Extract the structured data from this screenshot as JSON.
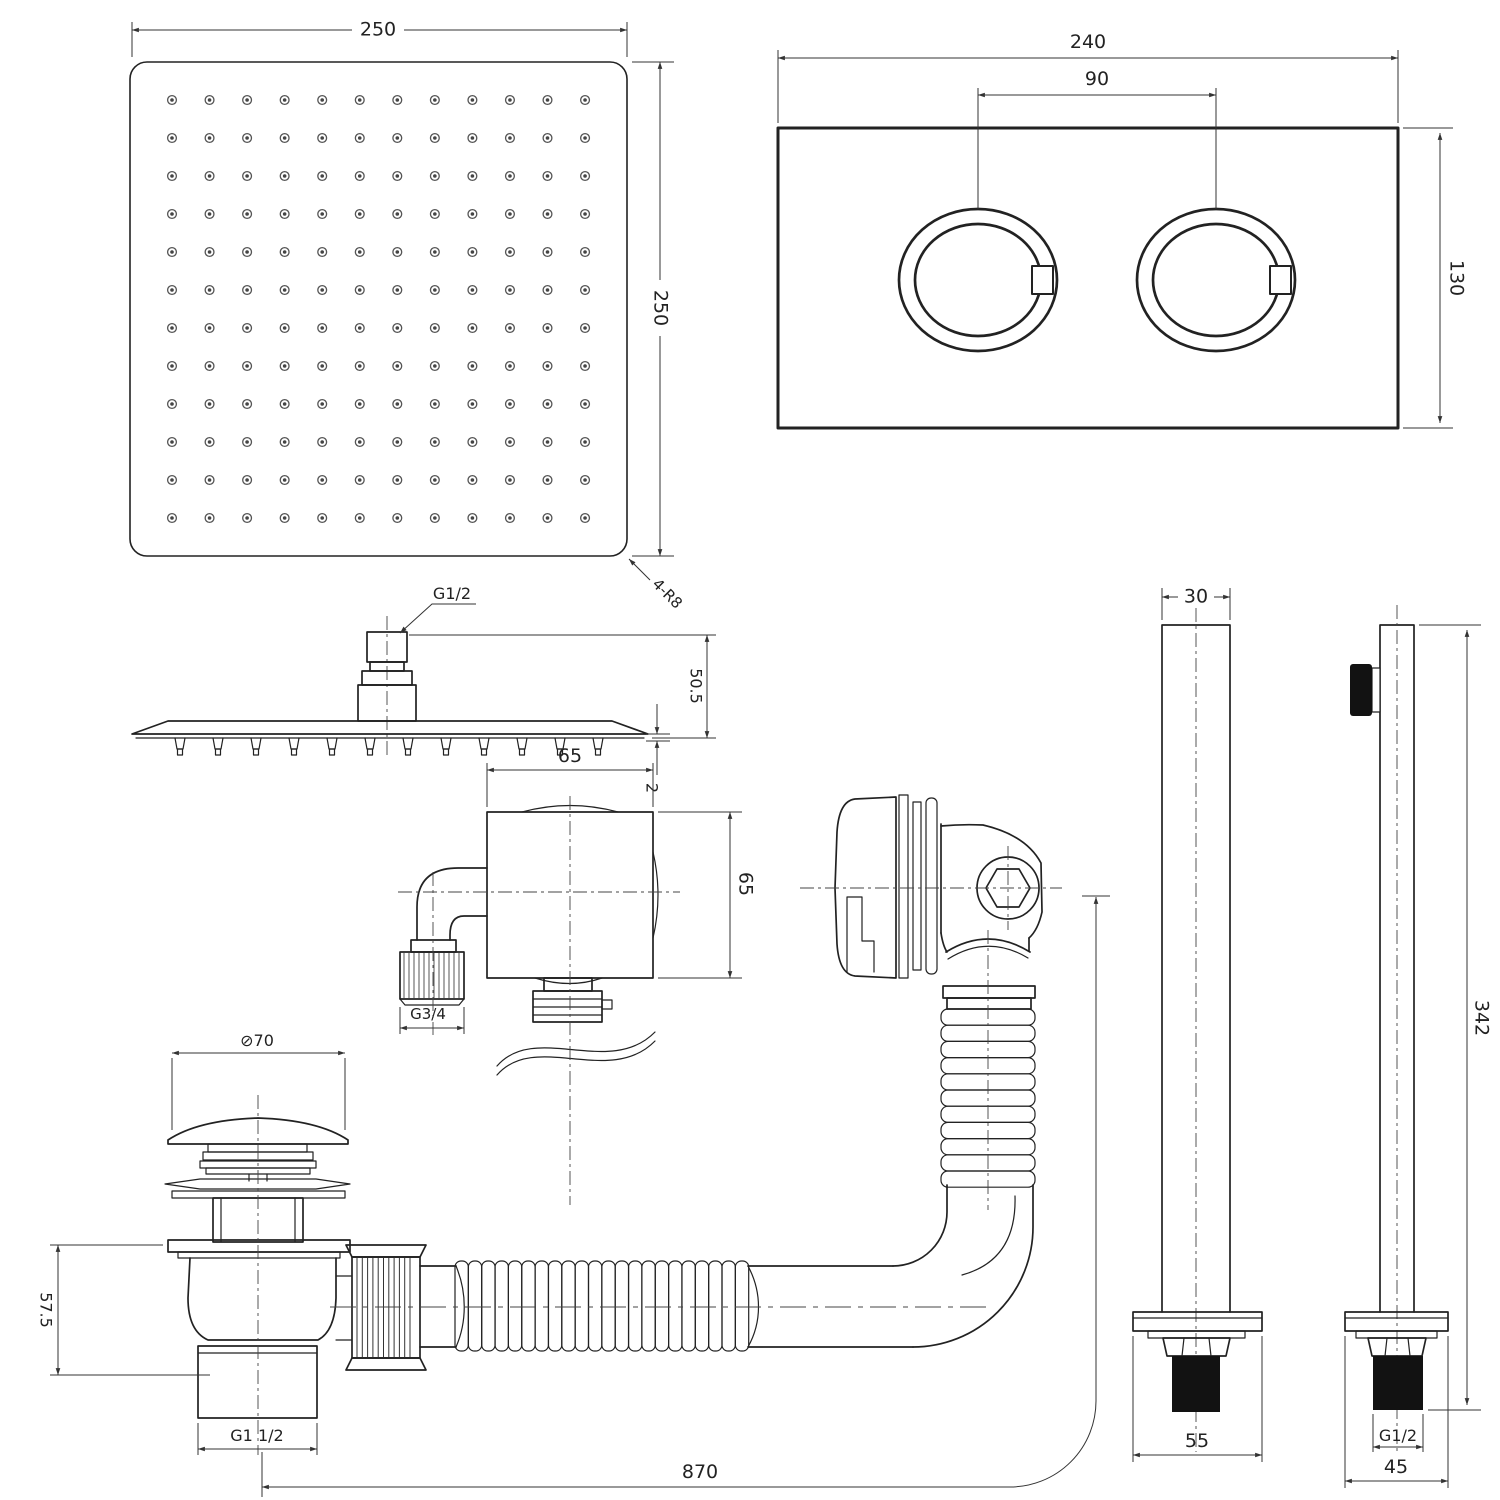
{
  "drawing": {
    "title": "shower-system-technical-drawing",
    "line_color": "#222222",
    "background": "#ffffff",
    "views": {
      "head_face": {
        "width_label": "250",
        "height_label": "250",
        "corner_radius_label": "4-R8",
        "nozzle_grid": {
          "rows": 12,
          "cols": 12
        }
      },
      "control_plate": {
        "width_label": "240",
        "knob_spacing_label": "90",
        "height_label": "130",
        "knob_count": 2
      },
      "head_side": {
        "thread_label": "G1/2",
        "height_label": "50.5",
        "thickness_label": "2",
        "nozzle_count": 12
      },
      "wall_outlet": {
        "width_label": "65",
        "height_label": "65",
        "thread_label": "G3/4"
      },
      "overflow": {
        "vertical_rib_count": 11
      },
      "drain": {
        "cap_diameter_label": "⊘70",
        "body_height_label": "57.5",
        "thread_label": "G1 1/2"
      },
      "hose": {
        "length_label": "870",
        "horizontal_rib_count": 22
      },
      "arm_left": {
        "width_label": "30",
        "base_width_label": "55"
      },
      "arm_right": {
        "length_label": "342",
        "thread_label": "G1/2",
        "base_width_label": "45"
      }
    }
  }
}
